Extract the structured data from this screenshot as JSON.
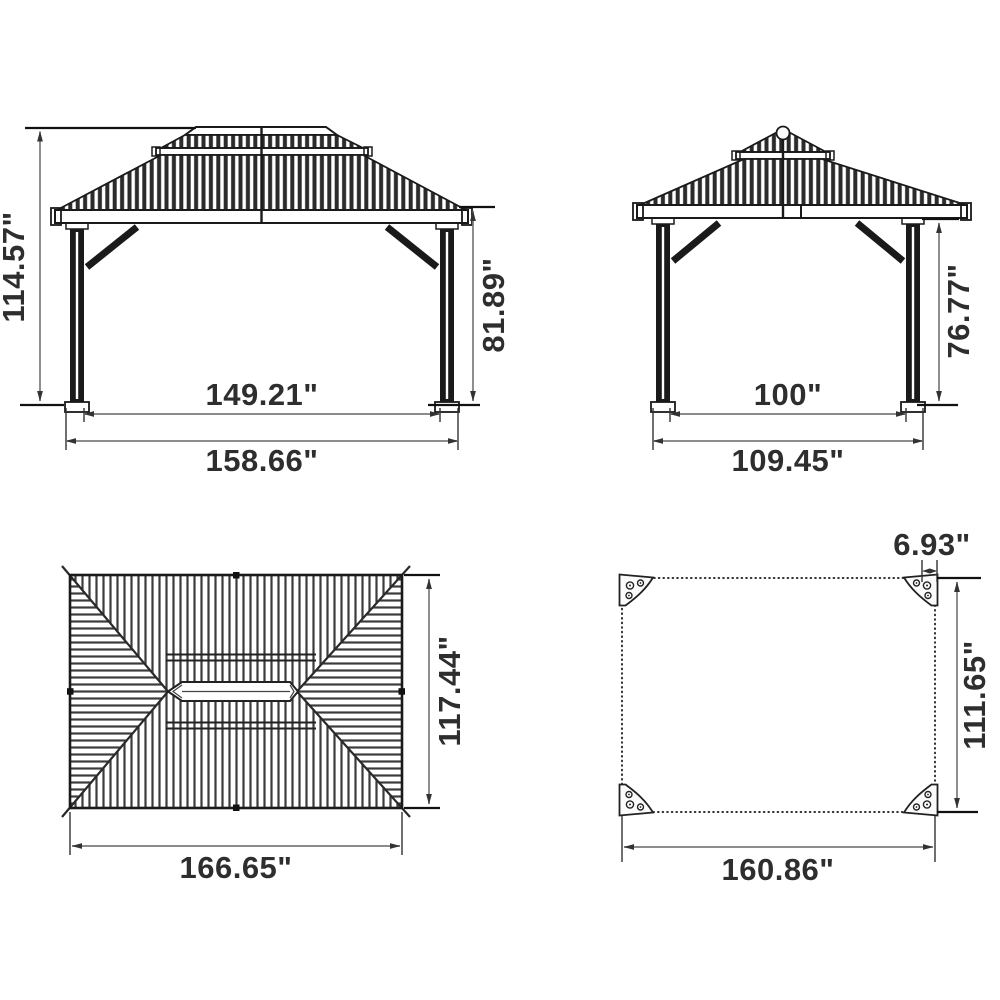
{
  "drawing": {
    "type": "gazebo-dimension-diagram",
    "views": {
      "front": {
        "total_height": "114.57\"",
        "eave_height": "81.89\"",
        "inner_width": "149.21\"",
        "outer_width": "158.66\""
      },
      "side": {
        "eave_height": "76.77\"",
        "inner_width": "100\"",
        "outer_width": "109.45\""
      },
      "roof": {
        "depth": "117.44\"",
        "width": "166.65\""
      },
      "base": {
        "bracket_width": "6.93\"",
        "depth": "111.65\"",
        "width": "160.86\""
      }
    },
    "colors": {
      "background": "#ffffff",
      "drawing_line": "#1a1a1a",
      "dimension_line": "#7b7b7b",
      "arrowhead": "#333333",
      "label_text": "#2e2e2e",
      "hatch": "#3c3c3c"
    }
  }
}
